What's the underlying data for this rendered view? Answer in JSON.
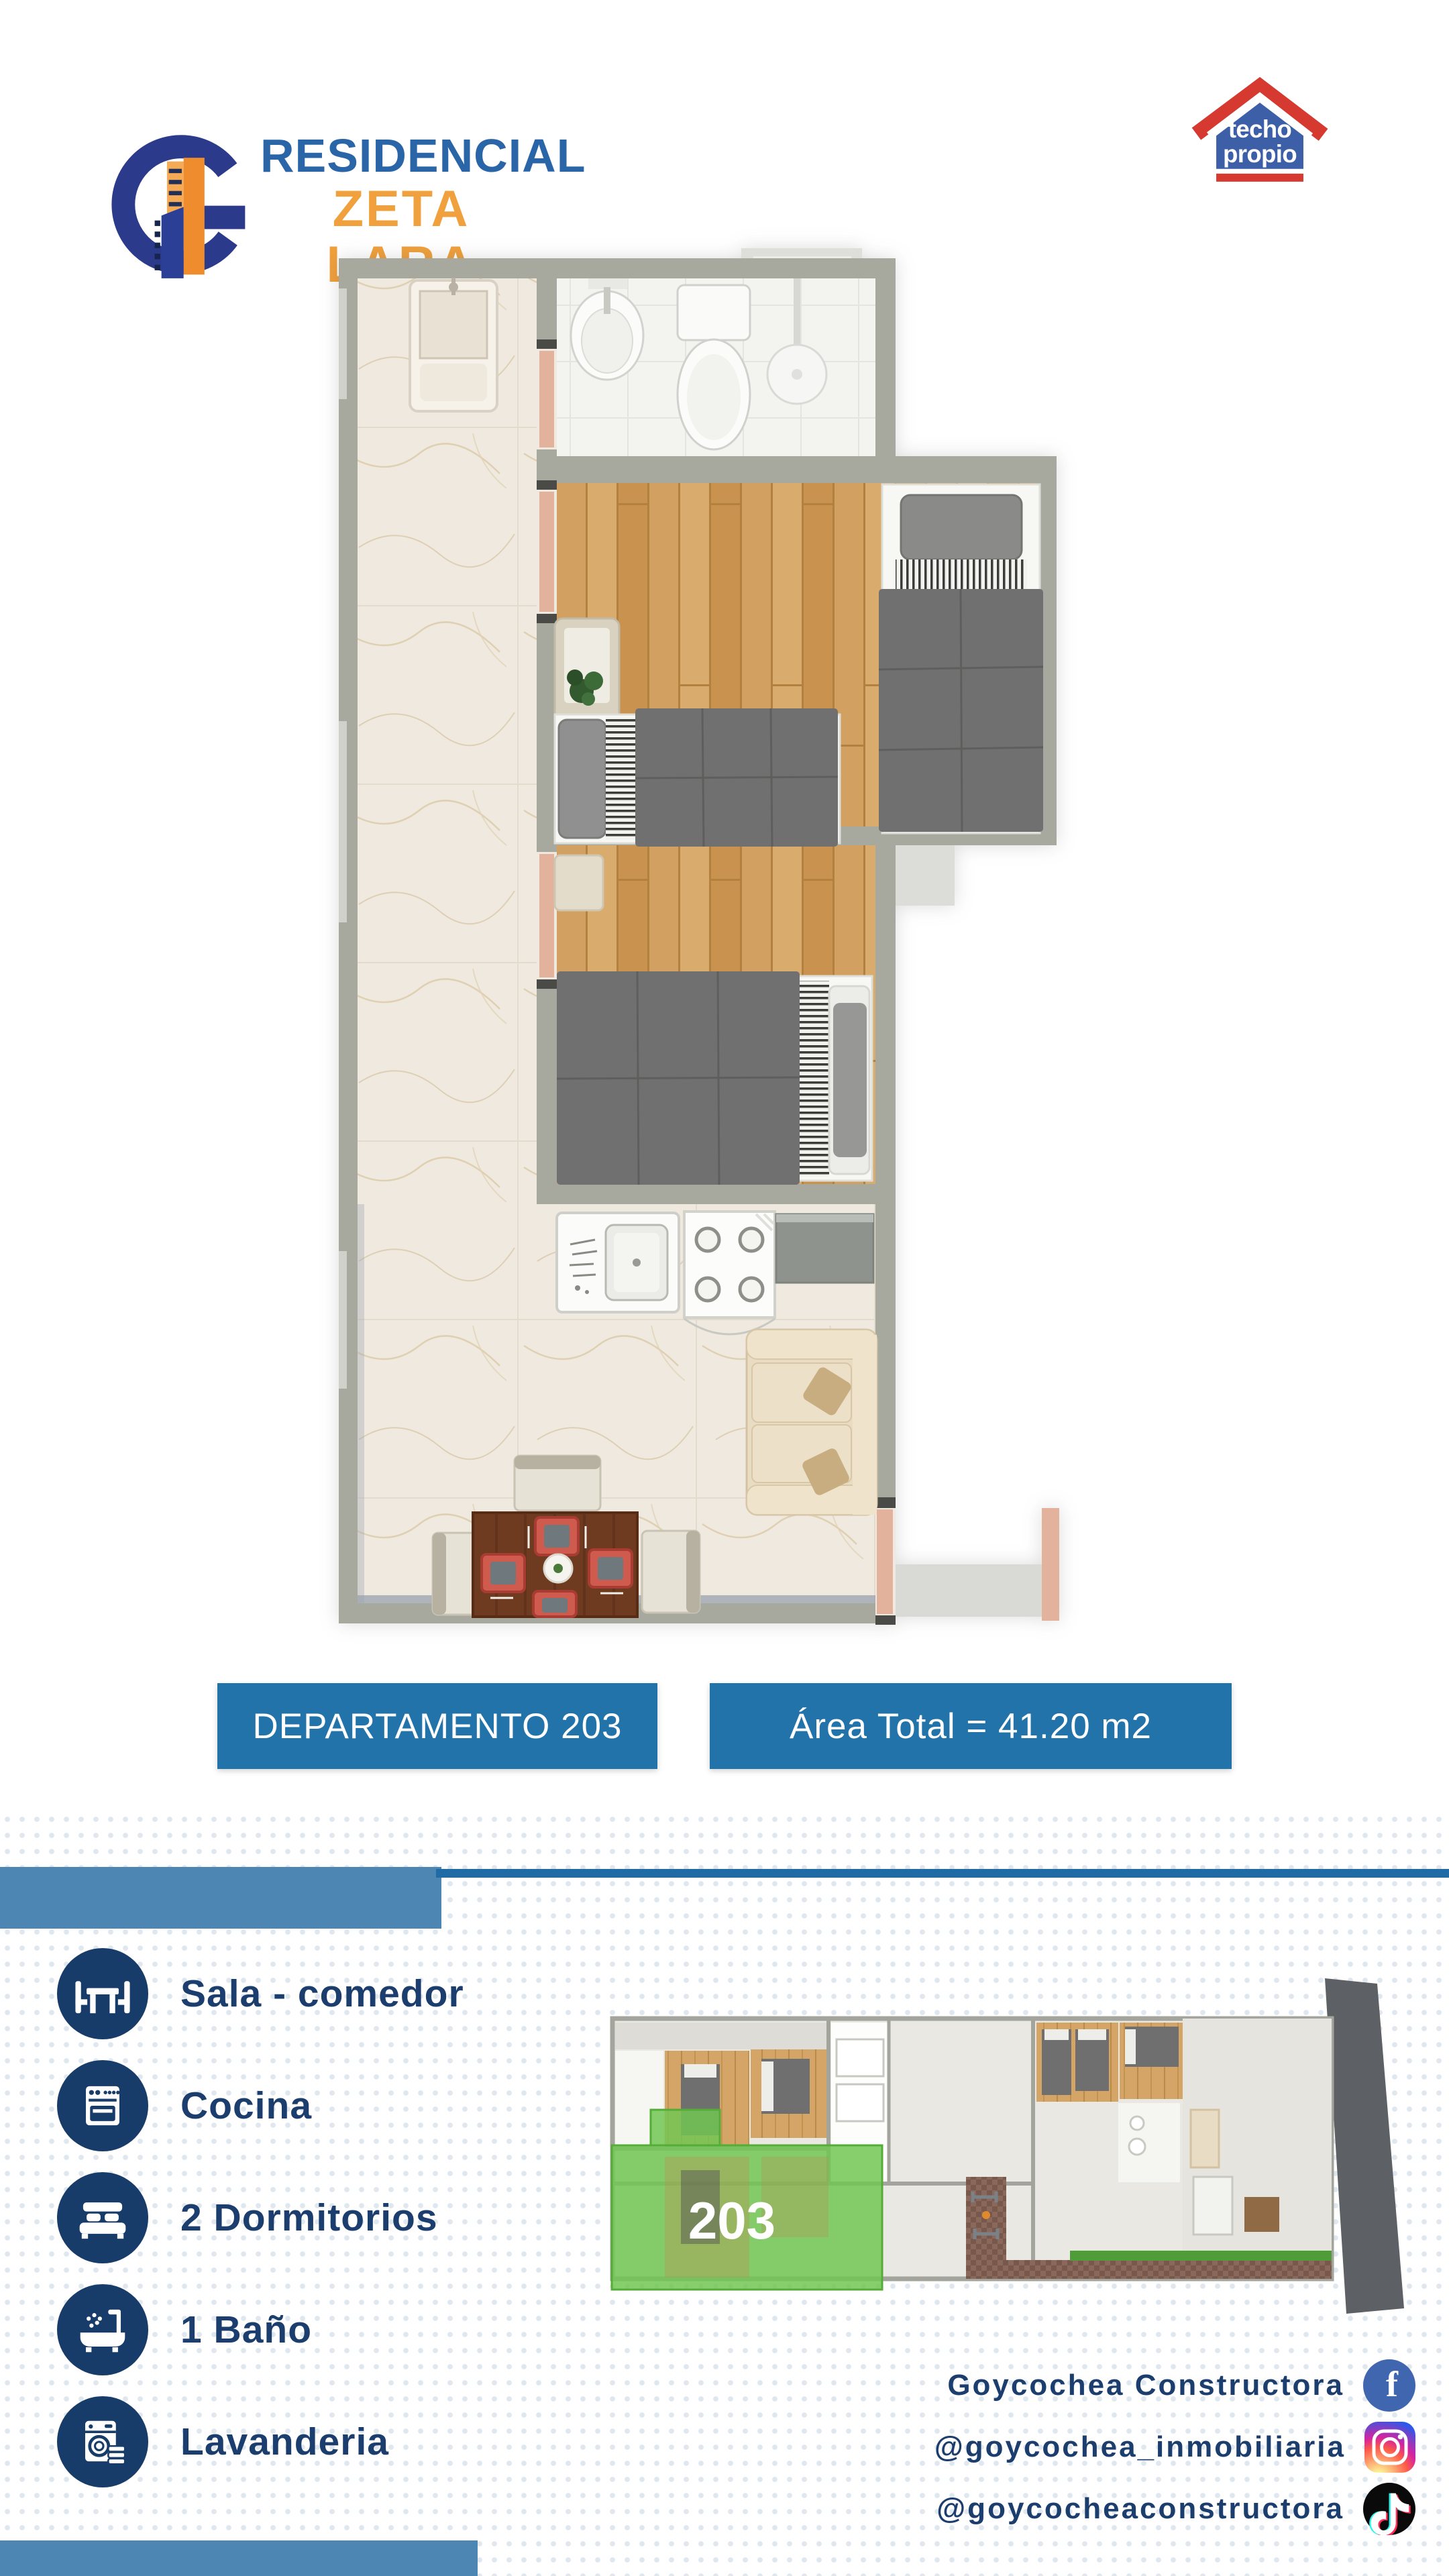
{
  "brand": {
    "line1": "RESIDENCIAL",
    "line2": "ZETA LARA"
  },
  "program_logo": {
    "word1": "techo",
    "word2": "propio"
  },
  "banners": {
    "unit": "DEPARTAMENTO 203",
    "area": "Área Total =  41.20 m2"
  },
  "features": [
    {
      "icon": "dining-table-icon",
      "label": "Sala - comedor"
    },
    {
      "icon": "stove-icon",
      "label": "Cocina"
    },
    {
      "icon": "bed-icon",
      "label": "2 Dormitorios"
    },
    {
      "icon": "bathtub-icon",
      "label": "1 Baño"
    },
    {
      "icon": "washing-machine-icon",
      "label": "Lavanderia"
    }
  ],
  "mini_plan": {
    "highlighted_unit": "203"
  },
  "social": [
    {
      "network": "facebook",
      "label": "Goycochea  Constructora"
    },
    {
      "network": "instagram",
      "label": "@goycochea_inmobiliaria"
    },
    {
      "network": "tiktok",
      "label": "@goycocheaconstructora"
    }
  ],
  "colors": {
    "banner_blue": "#2273a9",
    "divider_light_blue": "#4d86b3",
    "divider_dark_blue": "#1e6ba5",
    "navy": "#1c3e6e",
    "brand_blue": "#2a65a8",
    "brand_orange": "#f0a03c",
    "highlight_green": "#72c653",
    "roof_red": "#d6392f",
    "wall_gray": "#a7a99f"
  }
}
